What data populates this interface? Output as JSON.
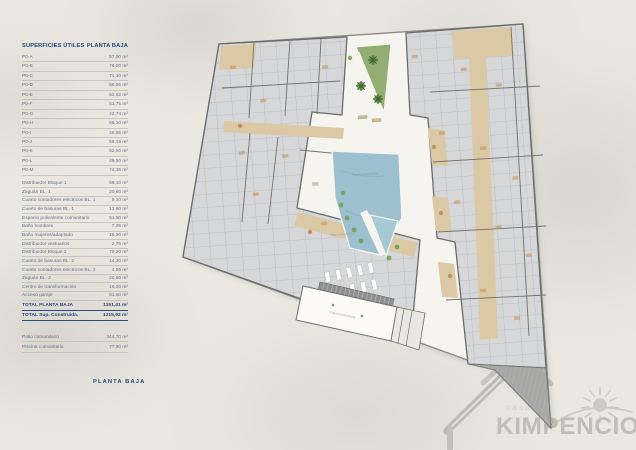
{
  "table": {
    "header": {
      "left": "SUPERFICIES ÚTILES",
      "right": "PLANTA BAJA"
    },
    "units": [
      {
        "label": "P0-A",
        "value": "57,00 m²"
      },
      {
        "label": "P0-B",
        "value": "76,00 m²"
      },
      {
        "label": "P0-C",
        "value": "71,10 m²"
      },
      {
        "label": "P0-D",
        "value": "69,55 m²"
      },
      {
        "label": "P0-E",
        "value": "53,52 m²"
      },
      {
        "label": "P0-F",
        "value": "51,75 m²"
      },
      {
        "label": "P0-G",
        "value": "42,74 m²"
      },
      {
        "label": "P0-H",
        "value": "65,10 m²"
      },
      {
        "label": "P0-I",
        "value": "46,65 m²"
      },
      {
        "label": "P0-J",
        "value": "59,15 m²"
      },
      {
        "label": "P0-K",
        "value": "52,50 m²"
      },
      {
        "label": "P0-L",
        "value": "49,50 m²"
      },
      {
        "label": "P0-M",
        "value": "74,15 m²"
      }
    ],
    "commons": [
      {
        "label": "Distribuidor Bloque 1",
        "value": "58,10 m²"
      },
      {
        "label": "Zaguán BL. 1",
        "value": "20,60 m²"
      },
      {
        "label": "Cuarto contadores eléctricos BL. 1",
        "value": "5,10 m²"
      },
      {
        "label": "Cuarto de basuras BL. 1",
        "value": "13,60 m²"
      },
      {
        "label": "Espacio polivalente comunitario",
        "value": "51,50 m²"
      },
      {
        "label": "Baño hombres",
        "value": "7,05 m²"
      },
      {
        "label": "Baño mujeres/adaptado",
        "value": "15,90 m²"
      },
      {
        "label": "Distribuidor vestuarios",
        "value": "2,75 m²"
      },
      {
        "label": "Distribuidor Bloque 2",
        "value": "70,20 m²"
      },
      {
        "label": "Cuarto de basuras BL. 2",
        "value": "14,30 m²"
      },
      {
        "label": "Cuarto contadores eléctricos BL. 2",
        "value": "4,85 m²"
      },
      {
        "label": "Zaguán BL. 2",
        "value": "20,80 m²"
      },
      {
        "label": "Centro de transformación",
        "value": "16,30 m²"
      },
      {
        "label": "Acceso garaje",
        "value": "81,50 m²"
      }
    ],
    "totals": [
      {
        "label": "TOTAL PLANTA BAJA",
        "value": "1151,41 m²"
      },
      {
        "label": "TOTAL Sup. Construida.",
        "value": "1215,92 m²"
      }
    ],
    "outdoor": [
      {
        "label": "Patio comunitario",
        "value": "344,70 m²"
      },
      {
        "label": "Piscina comunitaria",
        "value": "77,50 m²"
      }
    ]
  },
  "footer": {
    "title": "PLANTA BAJA"
  },
  "logo": {
    "brand": "KIMPENCIO",
    "tagline": "casas"
  },
  "plan": {
    "labels": {
      "patio": "Patio comunitario",
      "pool": "Piscina comunitaria",
      "hall": "Espacio polivalente"
    }
  },
  "colors": {
    "accent_navy": "#27477b",
    "row_text": "#66728a",
    "pool_blue": "#9cc0cd",
    "garden_green": "#93ae72",
    "building_gray": "#d6d7d9",
    "corridor_tan": "#dbc9a6",
    "wall_gray": "#6e6e6c",
    "watermark_gray": "#c1beb8"
  }
}
